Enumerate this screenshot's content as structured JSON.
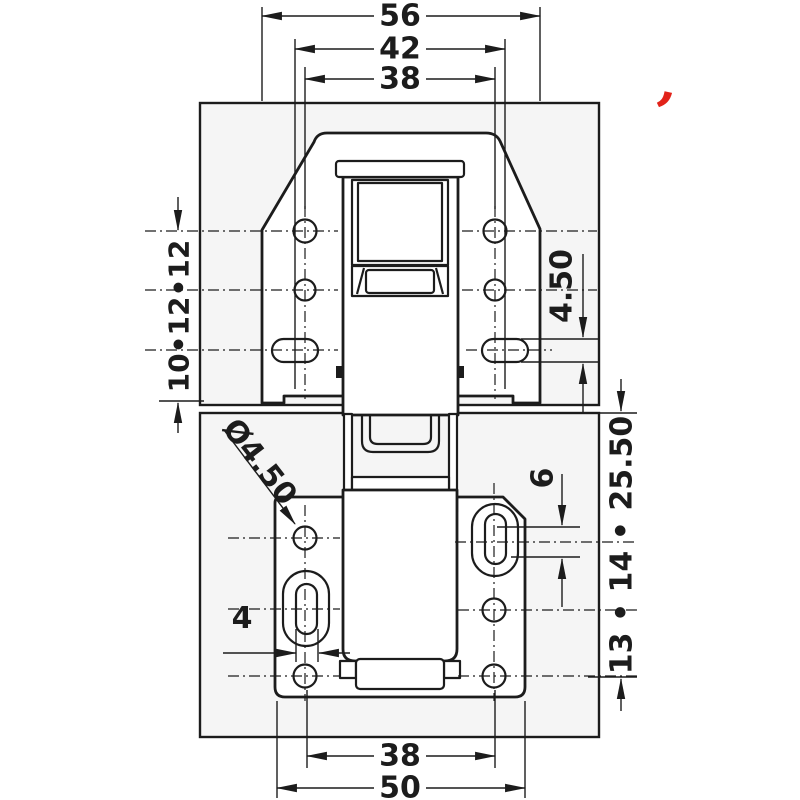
{
  "drawing": {
    "description": "Concealed hinge installation technical drawing, front view, hinge mounted across two panels",
    "colors": {
      "line": "#1c1c1c",
      "panel_fill": "#f5f5f5",
      "part_fill": "#ffffff",
      "logo_red": "#e2231a"
    }
  },
  "dims": {
    "top_outer": "56",
    "top_middle": "42",
    "top_inner": "38",
    "left_chain": "10•12•12",
    "top_slot_width": "4.50",
    "right_chain": "13 • 14 • 25.50",
    "slot_length": "6",
    "hole_diameter": "Ø4.50",
    "bottom_slot_width": "4",
    "bottom_inner": "38",
    "bottom_outer": "50"
  },
  "logo": {
    "glyph": "’"
  }
}
